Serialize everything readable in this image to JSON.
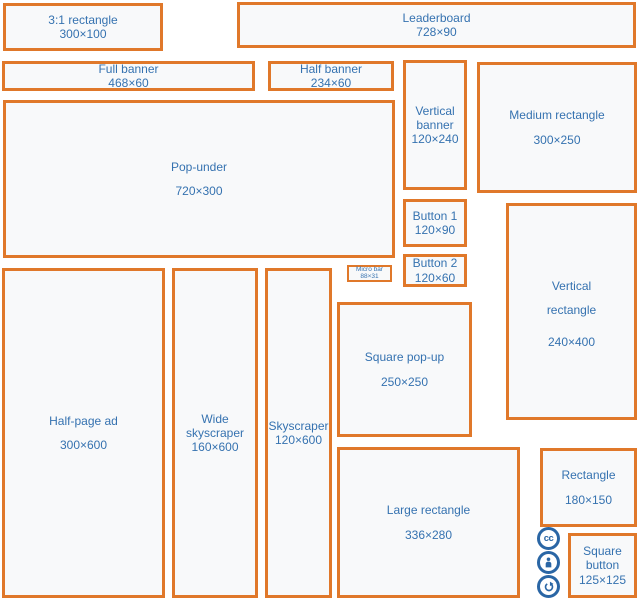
{
  "diagram": {
    "description": "Standard web banner ad sizes diagram",
    "colors": {
      "box_border": "#e0782a",
      "label_text": "#3572b0",
      "box_fill": "#f8f9fa",
      "license_icon_blue": "#2a66a5",
      "page_background": "#ffffff"
    },
    "boxes": [
      {
        "name": "3:1 rectangle",
        "size": "300×100"
      },
      {
        "name": "Leaderboard",
        "size": "728×90"
      },
      {
        "name": "Full banner",
        "size": "468×60"
      },
      {
        "name": "Half banner",
        "size": "234×60"
      },
      {
        "name": "Vertical banner",
        "size": "120×240"
      },
      {
        "name": "Medium rectangle",
        "size": "300×250"
      },
      {
        "name": "Pop-under",
        "size": "720×300"
      },
      {
        "name": "Button 1",
        "size": "120×90"
      },
      {
        "name": "Button 2",
        "size": "120×60"
      },
      {
        "name": "Micro bar",
        "size": "88×31"
      },
      {
        "name": "Vertical rectangle",
        "size": "240×400"
      },
      {
        "name": "Half-page ad",
        "size": "300×600"
      },
      {
        "name": "Wide skyscraper",
        "size": "160×600"
      },
      {
        "name": "Skyscraper",
        "size": "120×600"
      },
      {
        "name": "Square pop-up",
        "size": "250×250"
      },
      {
        "name": "Large rectangle",
        "size": "336×280"
      },
      {
        "name": "Rectangle",
        "size": "180×150"
      },
      {
        "name": "Square button",
        "size": "125×125"
      }
    ],
    "icons": [
      {
        "name": "creative-commons-icon",
        "glyph": "cc"
      },
      {
        "name": "attribution-icon"
      },
      {
        "name": "share-alike-icon"
      }
    ]
  }
}
